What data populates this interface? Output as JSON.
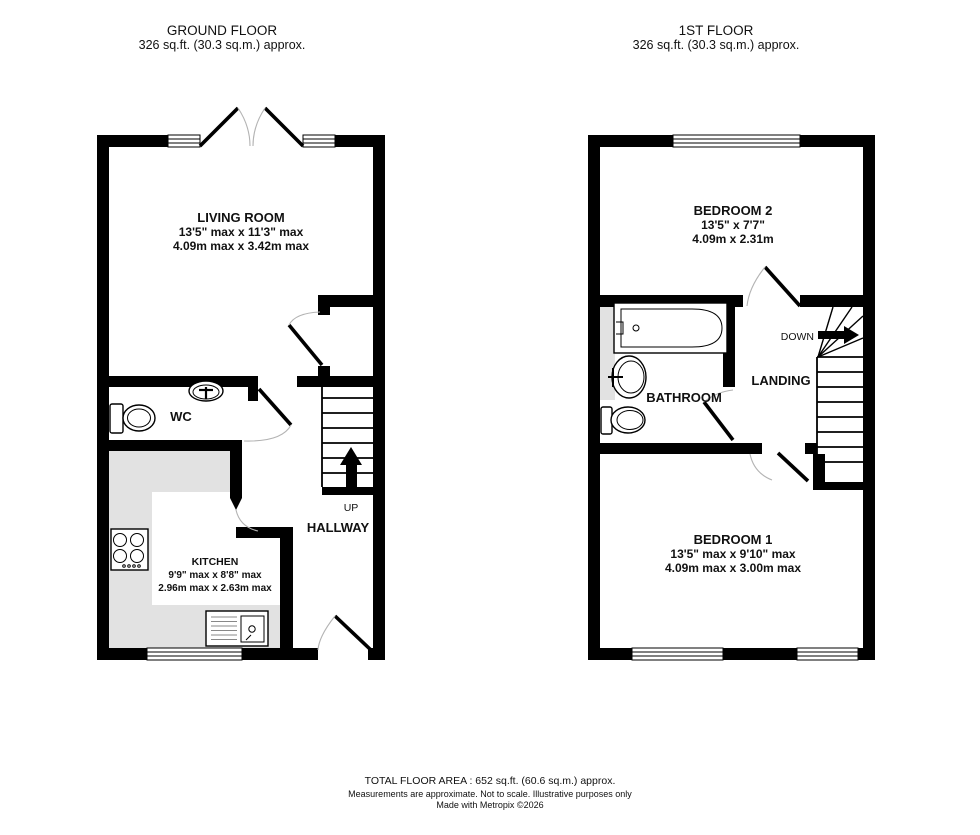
{
  "header": {
    "ground_floor": {
      "title": "GROUND FLOOR",
      "area": "326 sq.ft. (30.3 sq.m.) approx."
    },
    "first_floor": {
      "title": "1ST FLOOR",
      "area": "326 sq.ft. (30.3 sq.m.) approx."
    }
  },
  "rooms": {
    "living_room": {
      "name": "LIVING ROOM",
      "imperial": "13'5\" max x 11'3\" max",
      "metric": "4.09m max x 3.42m max"
    },
    "kitchen": {
      "name": "KITCHEN",
      "imperial": "9'9\" max x 8'8\" max",
      "metric": "2.96m max x 2.63m max"
    },
    "wc": {
      "name": "WC"
    },
    "hallway": {
      "name": "HALLWAY"
    },
    "bedroom2": {
      "name": "BEDROOM 2",
      "imperial": "13'5\"  x 7'7\"",
      "metric": "4.09m  x 2.31m"
    },
    "bathroom": {
      "name": "BATHROOM"
    },
    "landing": {
      "name": "LANDING"
    },
    "bedroom1": {
      "name": "BEDROOM 1",
      "imperial": "13'5\" max x 9'10\" max",
      "metric": "4.09m max x 3.00m max"
    }
  },
  "stairs": {
    "up_label": "UP",
    "down_label": "DOWN"
  },
  "footer": {
    "total_area": "TOTAL FLOOR AREA : 652 sq.ft. (60.6 sq.m.) approx.",
    "disclaimer": "Measurements are approximate.  Not to scale.  Illustrative purposes only",
    "credit": "Made with Metropix ©2026"
  },
  "colors": {
    "wall": "#000000",
    "floor_shading": "#e2e2e2",
    "background": "#ffffff"
  }
}
